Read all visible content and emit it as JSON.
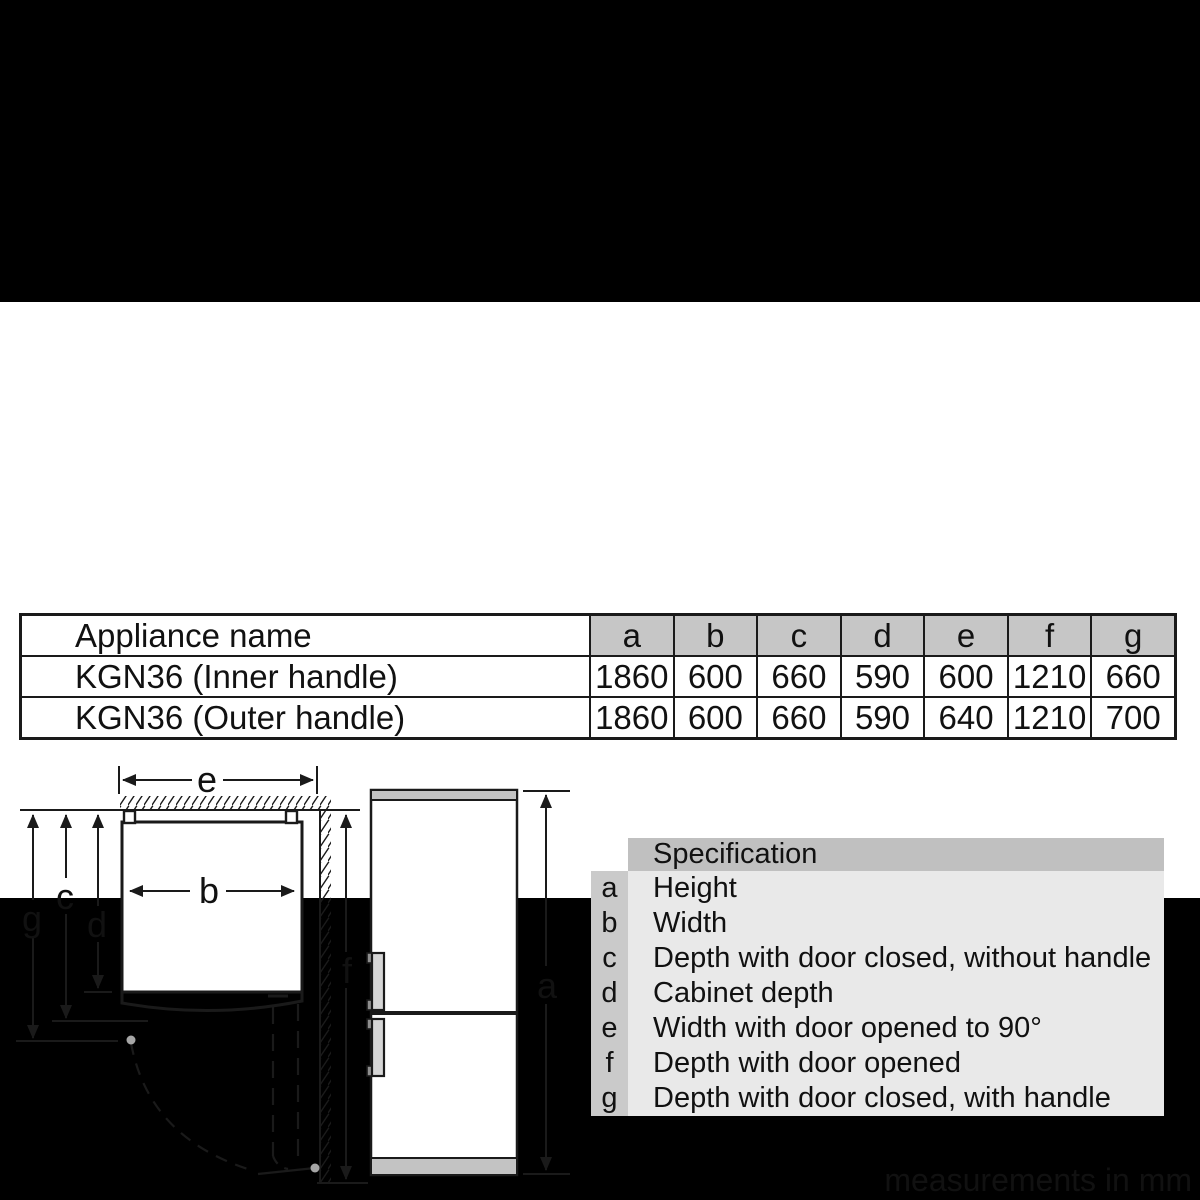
{
  "page": {
    "footer_note": "measurements in mm"
  },
  "colors": {
    "letterbox": "#000000",
    "background": "#ffffff",
    "table_header_bg": "#c6c6c6",
    "spec_title_bg": "#c0c0c0",
    "spec_key_bg": "#cacaca",
    "spec_body_bg": "#e9e9e9",
    "line": "#1a1a1a",
    "panel_gray_fill": "#c3c3c3"
  },
  "dimensions_table": {
    "name_header": "Appliance name",
    "columns": [
      "a",
      "b",
      "c",
      "d",
      "e",
      "f",
      "g"
    ],
    "rows": [
      {
        "name": "KGN36 (Inner handle)",
        "values": [
          "1860",
          "600",
          "660",
          "590",
          "600",
          "1210",
          "660"
        ]
      },
      {
        "name": "KGN36 (Outer handle)",
        "values": [
          "1860",
          "600",
          "660",
          "590",
          "640",
          "1210",
          "700"
        ]
      }
    ]
  },
  "specification_legend": {
    "title": "Specification",
    "items": [
      {
        "key": "a",
        "label": "Height"
      },
      {
        "key": "b",
        "label": "Width"
      },
      {
        "key": "c",
        "label": "Depth with door closed, without handle"
      },
      {
        "key": "d",
        "label": "Cabinet depth"
      },
      {
        "key": "e",
        "label": "Width with door opened to 90°"
      },
      {
        "key": "f",
        "label": "Depth with door opened"
      },
      {
        "key": "g",
        "label": "Depth with door closed, with handle"
      }
    ]
  },
  "diagram": {
    "labels": {
      "a": "a",
      "b": "b",
      "c": "c",
      "d": "d",
      "e": "e",
      "f": "f",
      "g": "g"
    }
  }
}
